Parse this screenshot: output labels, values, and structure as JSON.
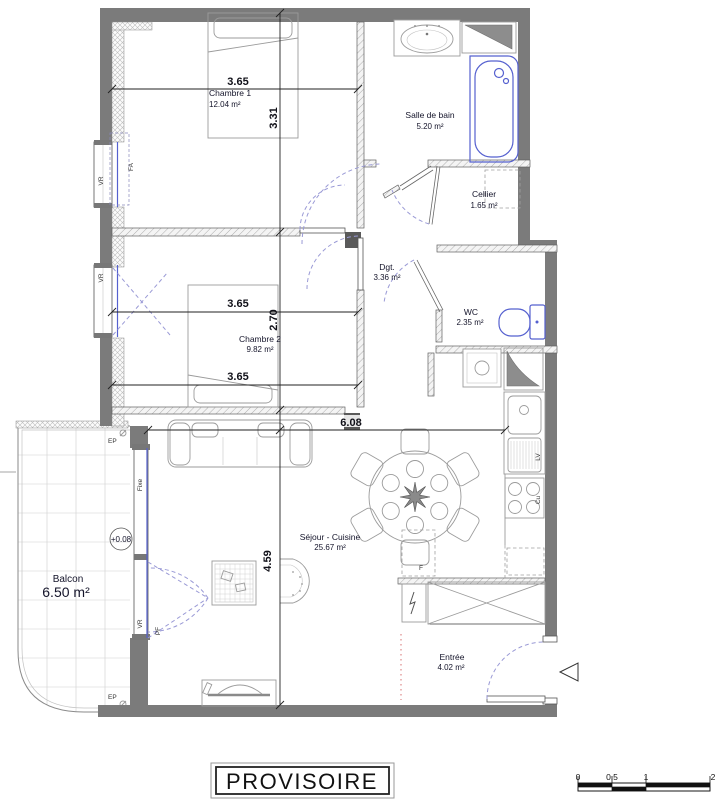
{
  "banner": {
    "label": "PROVISOIRE"
  },
  "rooms": {
    "chambre1": {
      "name": "Chambre 1",
      "area": "12.04 m²"
    },
    "salle_de_bain": {
      "name": "Salle de bain",
      "area": "5.20 m²"
    },
    "cellier": {
      "name": "Cellier",
      "area": "1.65 m²"
    },
    "degagement": {
      "name": "Dgt.",
      "area": "3.36 m²"
    },
    "wc": {
      "name": "WC",
      "area": "2.35 m²"
    },
    "chambre2": {
      "name": "Chambre 2",
      "area": "9.82 m²"
    },
    "sejour_cuisine": {
      "name": "Séjour - Cuisine",
      "area": "25.67 m²"
    },
    "entree": {
      "name": "Entrée",
      "area": "4.02 m²"
    },
    "balcon": {
      "name": "Balcon",
      "area": "6.50 m²",
      "level": "+0.08"
    }
  },
  "dimensions": {
    "chambre1_width": "3.65",
    "chambre1_depth": "3.31",
    "chambre2_width_top": "3.65",
    "chambre2_depth": "2.70",
    "chambre2_width_bottom": "3.65",
    "sejour_width": "6.08",
    "sejour_depth": "4.59"
  },
  "wall_labels": {
    "vr_chambre1": "VR",
    "fa_chambre1": "FA",
    "vr_chambre2": "VR",
    "fixe_balcon": "Fixe",
    "vr_balcon": "VR",
    "pf_balcon": "PF",
    "ep_top": "EP",
    "ep_bottom": "EP",
    "lv": "LV",
    "cu": "Cu",
    "refrigerateur": "F"
  },
  "scale_bar": {
    "ticks": [
      "0",
      "0.5",
      "1",
      "2"
    ]
  },
  "colors": {
    "wall": "#7b7b7b",
    "fixture_blue": "#5560cf",
    "door_swing": "#9a9ad6",
    "entry_marker_red": "#dd8888"
  }
}
